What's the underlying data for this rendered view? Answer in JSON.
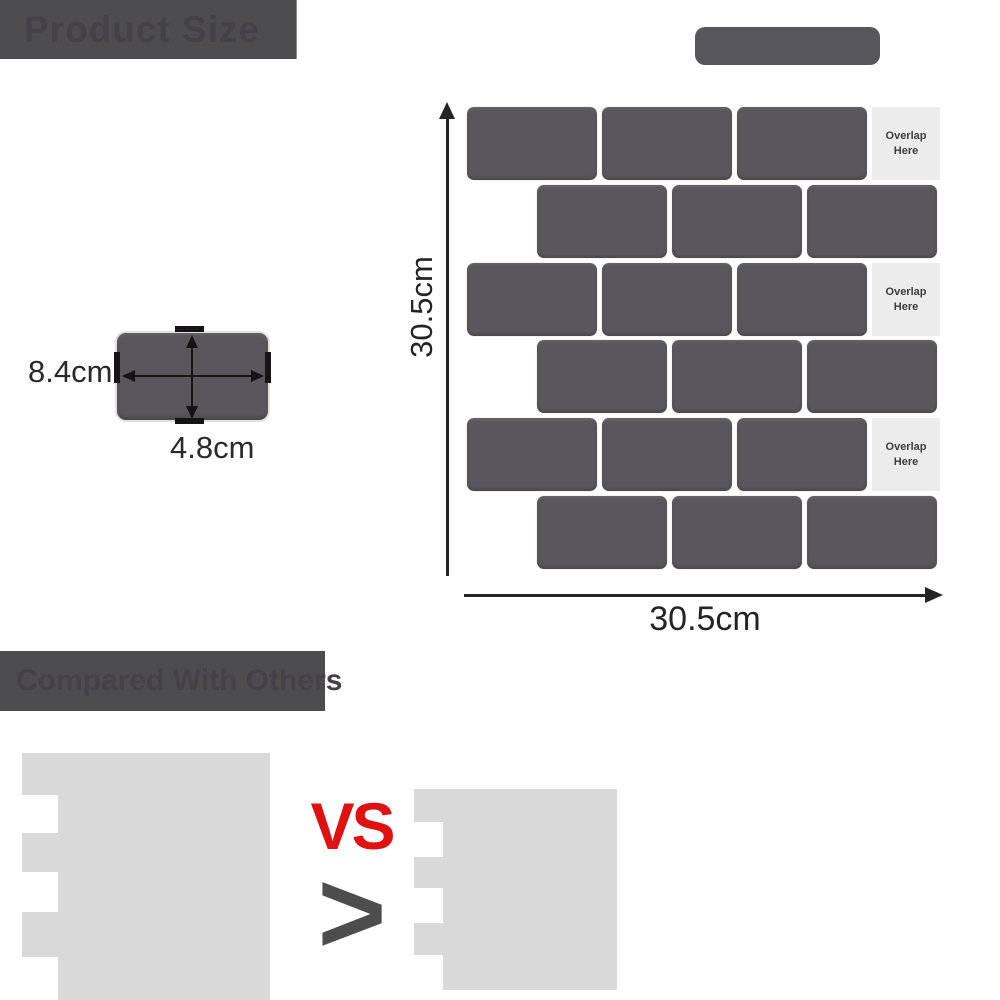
{
  "banners": {
    "product_size_label": "Product Size",
    "compare_label": "Compared With Others"
  },
  "panel": {
    "vertical_dimension": "30.5cm",
    "horizontal_dimension": "30.5cm",
    "overlap_labels": [
      "Overlap Here",
      "Overlap Here",
      "Overlap Here"
    ]
  },
  "single_tile": {
    "width_dimension": "8.4cm",
    "height_dimension": "4.8cm"
  },
  "comparison": {
    "vs_label": "VS",
    "greater_symbol": ">"
  },
  "colors": {
    "banner": "#4d4c4e",
    "banner_text": "#444248",
    "pill": "#57565a",
    "tile": "#59575b",
    "overlap_strip": "#ececec",
    "overlap_text": "#3d3d3d",
    "dimension": "#242424",
    "silhouette": "#d9d9d9",
    "vs_red": "#e01111",
    "chevron": "#4d4d4d"
  }
}
